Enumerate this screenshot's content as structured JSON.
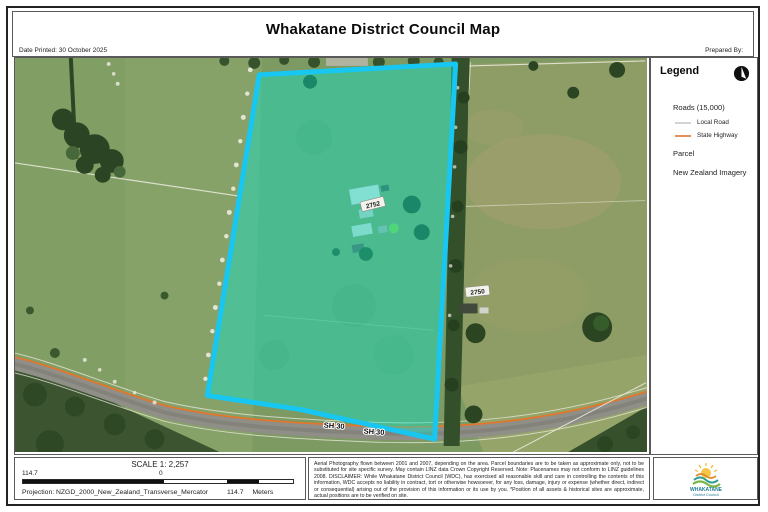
{
  "header": {
    "title": "Whakatane District Council Map",
    "date_printed": "Date Printed: 30 October 2025",
    "prepared_by": "Prepared By:"
  },
  "legend": {
    "title": "Legend",
    "north_arrow_icon": "north-arrow",
    "roads_group_label": "Roads (15,000)",
    "road_items": [
      {
        "label": "Local Road",
        "color": "#c9c9c9"
      },
      {
        "label": "State Highway",
        "color": "#e2762d"
      }
    ],
    "parcel_label": "Parcel",
    "imagery_label": "New Zealand Imagery"
  },
  "map": {
    "highlighted_parcel_label": "2752",
    "adjacent_parcel_label": "2750",
    "road_labels": [
      "SH 30",
      "SH 30"
    ],
    "colors": {
      "parcel_highlight_stroke": "#17c7f2",
      "parcel_highlight_fill": "rgba(0,235,210,0.40)",
      "state_highway": "#e2762d"
    }
  },
  "scale_bar": {
    "scale_text": "SCALE 1: 2,257",
    "left_value": "114.7",
    "zero_value": "0",
    "right_value": "114.7",
    "units": "Meters",
    "projection": "Projection: NZGD_2000_New_Zealand_Transverse_Mercator"
  },
  "disclaimer": "Aerial Photography flown between 2001 and 2007, depending on the area. Parcel boundaries are to be taken as approximate only, not to be substituted for site specific survey. May contain LINZ data Crown Copyright Reserved. Note: Placenames may not conform to LINZ guidelines 2008. DISCLAIMER: While Whakatane District Council (WDC), has exercised all reasonable skill and care in controlling the contents of this information, WDC accepts no liability in contract, tort or otherwise howsoever, for any loss, damage, injury or expense (whether direct, indirect or consequential) arising out of the provision of this information or its use by you. *Position of all assets & historical sites are approximate, actual positions are to be verified on site.",
  "logo": {
    "org_name": "WHAKATANE",
    "org_subtitle": "District Council"
  }
}
